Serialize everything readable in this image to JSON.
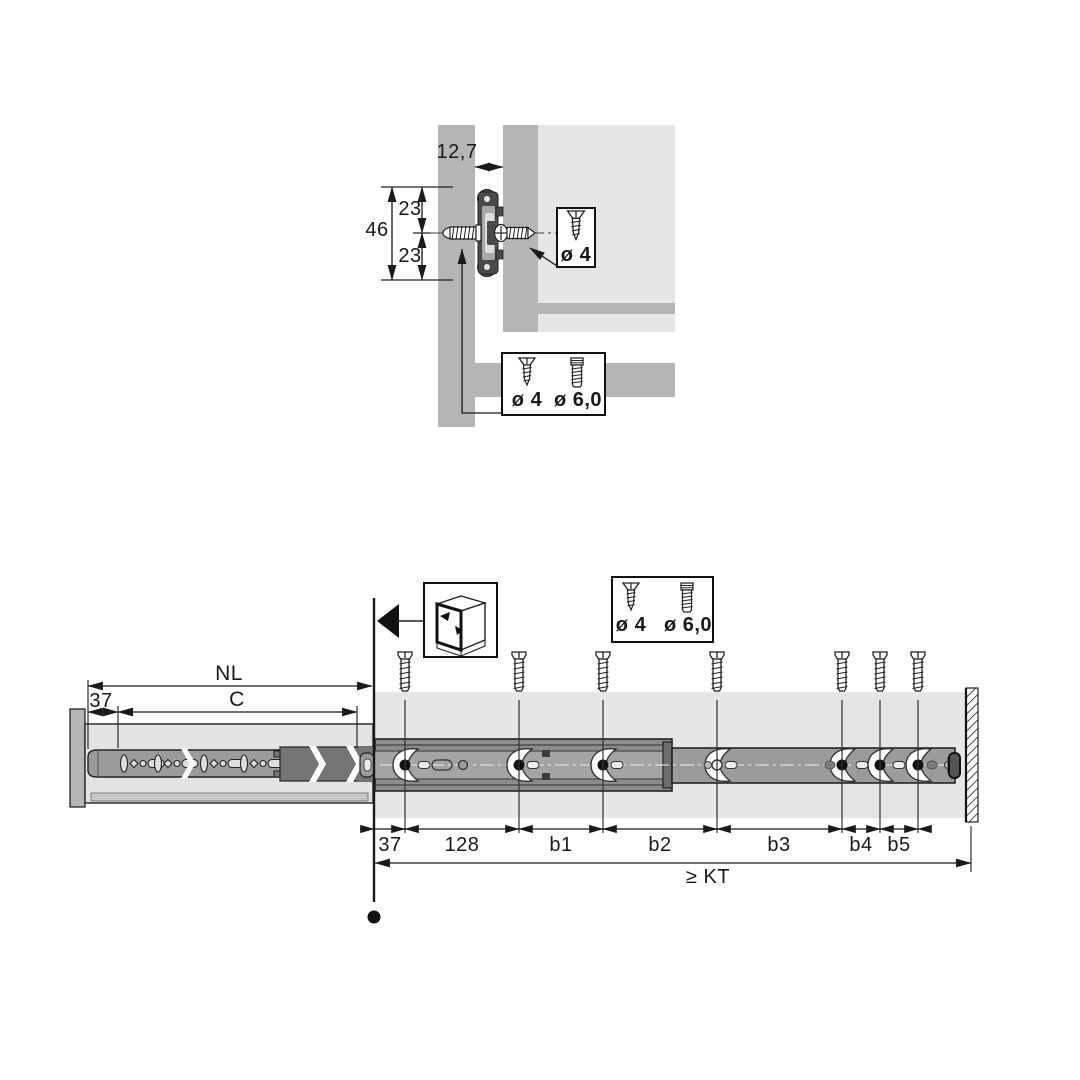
{
  "drawing": {
    "type": "furniture drawer-runner installation diagram",
    "colors": {
      "ink": "#1a1a1a",
      "panel_gray": "#b5b5b5",
      "light_gray": "#e6e6e6",
      "rail_gray": "#9b9b9b",
      "rail_dark_gray": "#757575",
      "slide_dark": "#4a4a4a",
      "background": "#ffffff"
    }
  },
  "top_view": {
    "dim_gap": "12,7",
    "dim_upper": "23",
    "dim_lower": "23",
    "dim_total": "46",
    "callout_screw": "ø 4",
    "screw_box": {
      "left": "ø 4",
      "right": "ø 6,0"
    }
  },
  "side_view": {
    "dim_rail_length": "NL",
    "dim_front_offset": "37",
    "dim_hole_span": "C",
    "screw_box": {
      "left": "ø 4",
      "right": "ø 6,0"
    },
    "segments": [
      "37",
      "128",
      "b1",
      "b2",
      "b3",
      "b4",
      "b5"
    ],
    "dim_cabinet_depth": "≥ KT"
  },
  "icons": {
    "cabinet_front_icon": "cabinet-front-mounting",
    "screw_vertical_icon": "pan-head-screw",
    "screw_countersunk_icon": "countersunk-screw",
    "screw_euro_icon": "euro-screw",
    "direction_arrow": "front-direction"
  }
}
